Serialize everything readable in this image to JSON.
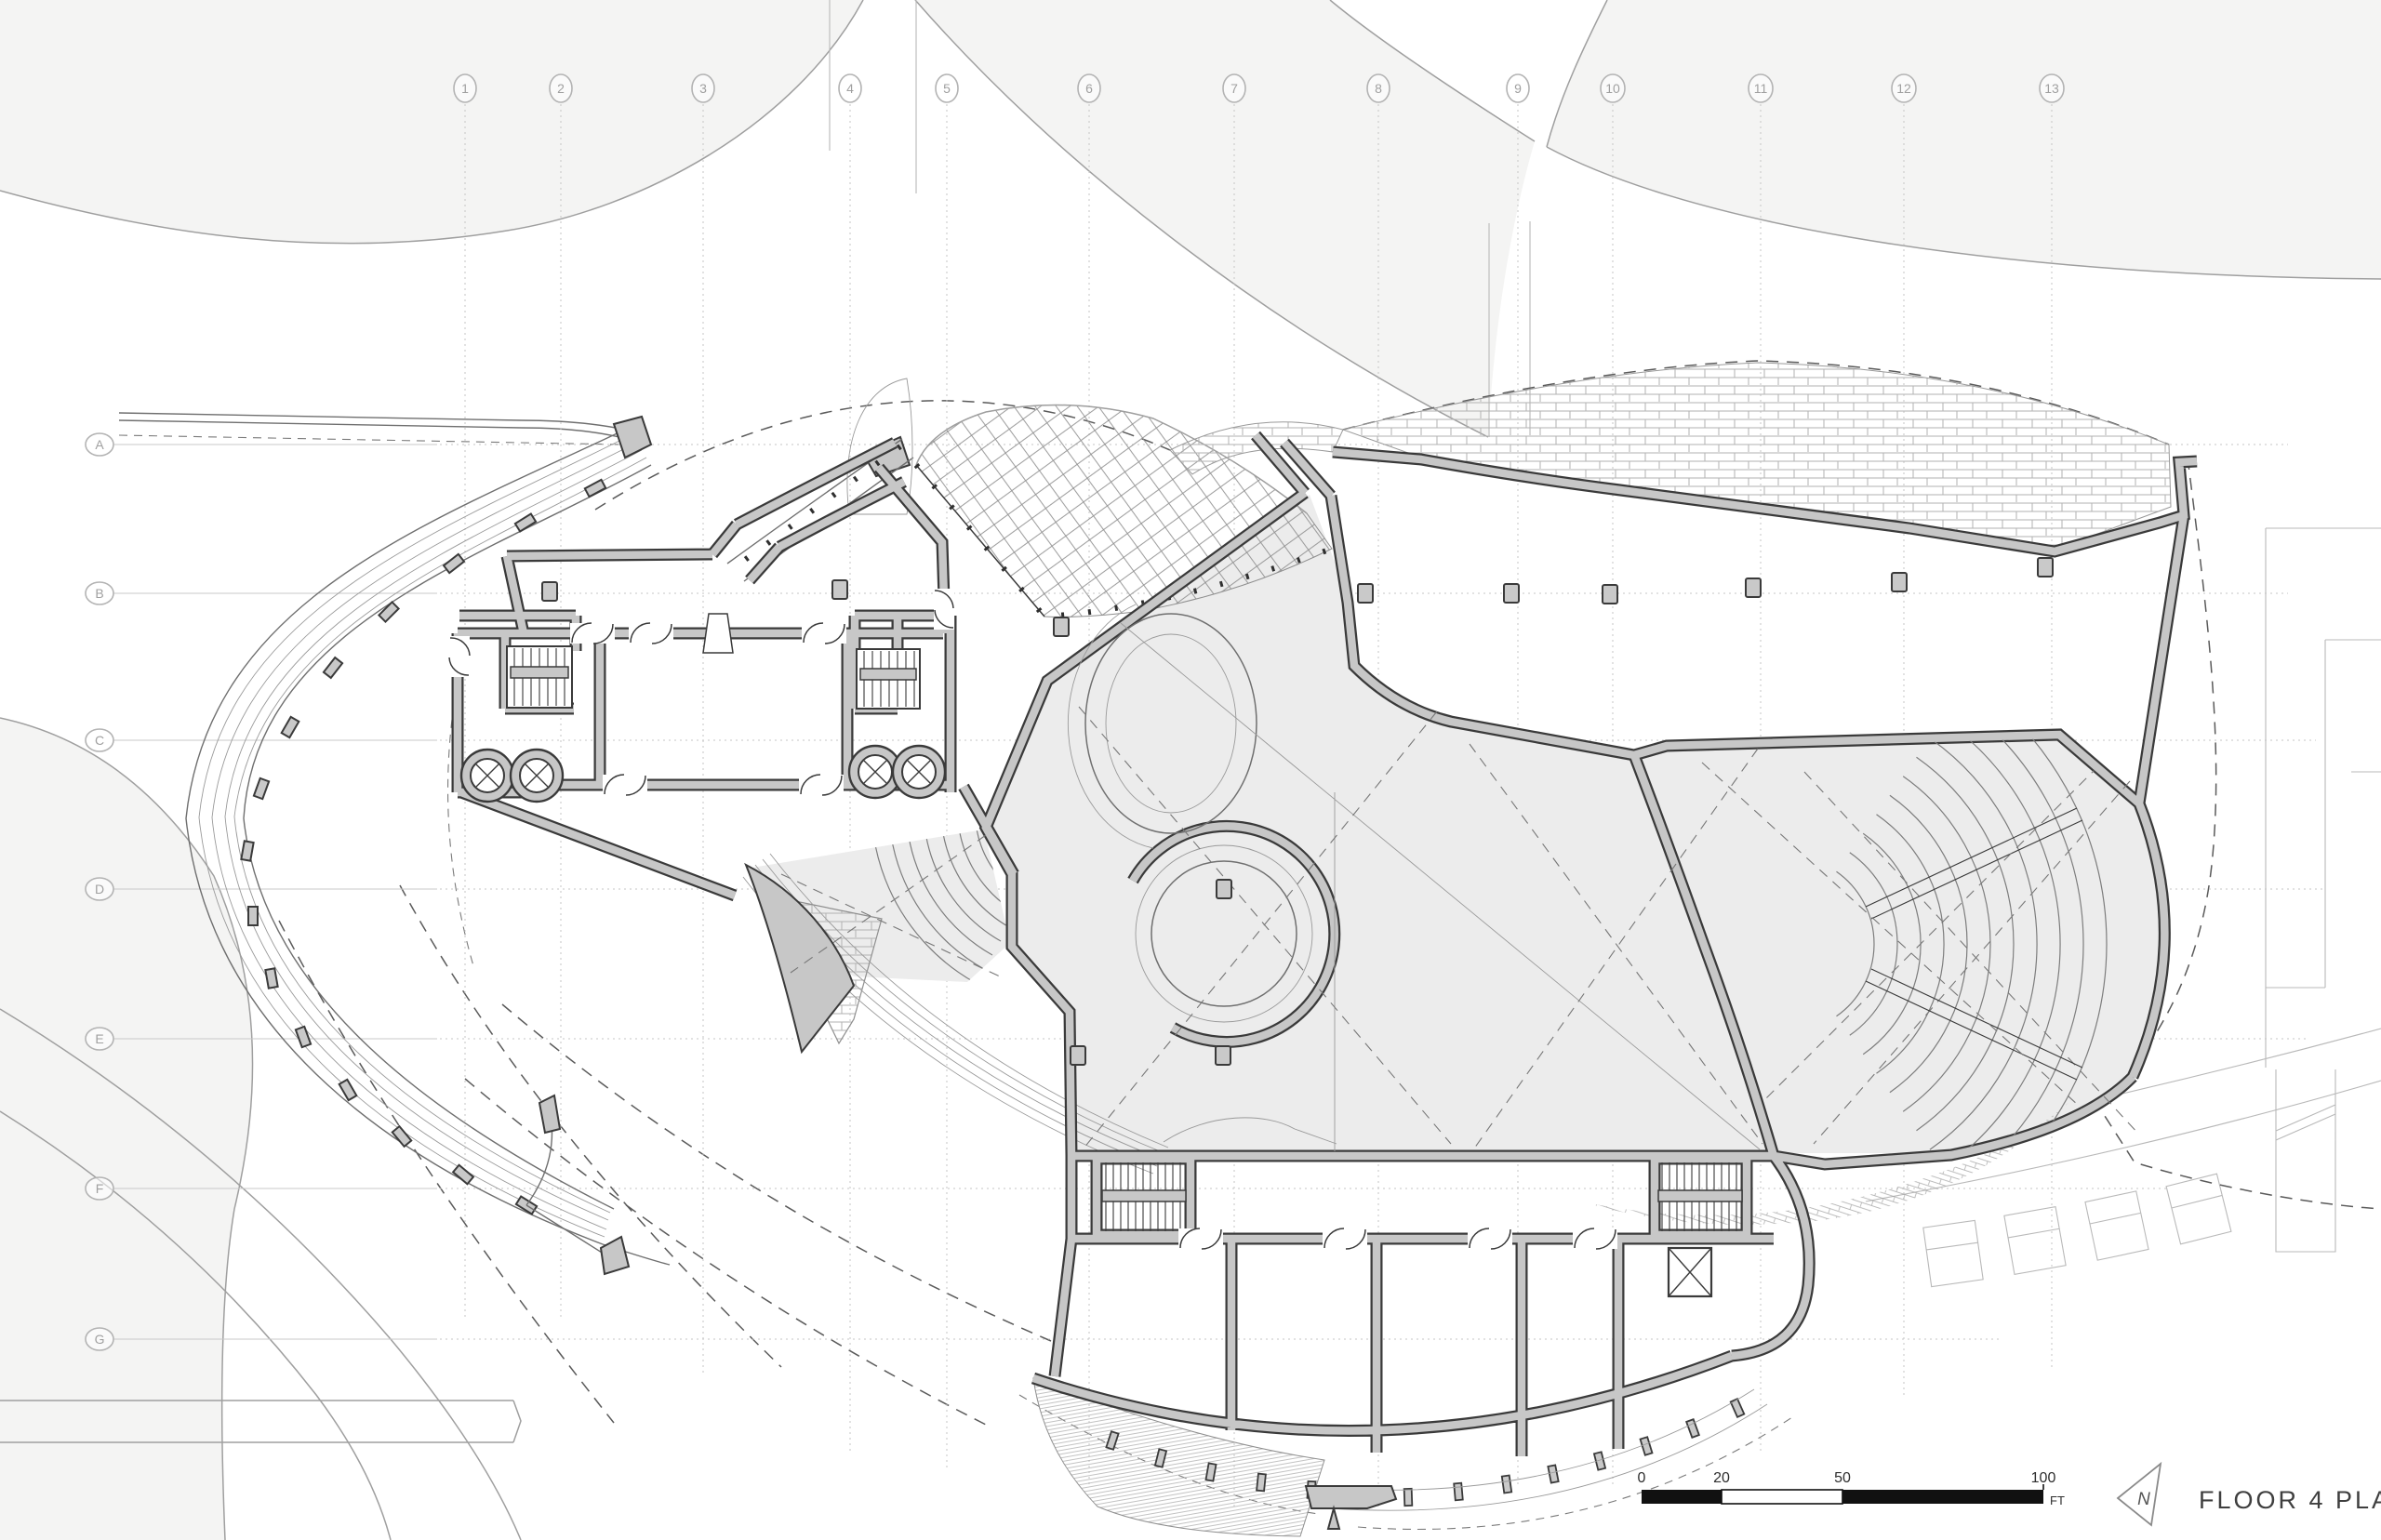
{
  "drawing": {
    "title": "FLOOR 4 PLAN",
    "north_label": "N"
  },
  "scale_bar": {
    "ticks": [
      "0",
      "20",
      "50",
      "100"
    ],
    "unit": "FT"
  },
  "grid": {
    "cols": [
      {
        "label": "1"
      },
      {
        "label": "2"
      },
      {
        "label": "3"
      },
      {
        "label": "4"
      },
      {
        "label": "5"
      },
      {
        "label": "6"
      },
      {
        "label": "7"
      },
      {
        "label": "8"
      },
      {
        "label": "9"
      },
      {
        "label": "10"
      },
      {
        "label": "11"
      },
      {
        "label": "12"
      },
      {
        "label": "13"
      }
    ],
    "rows": [
      {
        "label": "A"
      },
      {
        "label": "B"
      },
      {
        "label": "C"
      },
      {
        "label": "D"
      },
      {
        "label": "E"
      },
      {
        "label": "F"
      },
      {
        "label": "G"
      }
    ]
  },
  "colors": {
    "wall_fill": "#c7c7c7",
    "wall_line": "#3a3a3a",
    "floor_open": "#ececec",
    "context_line": "#9f9f9f",
    "grid_line": "#c6c6c6",
    "paper": "#ffffff"
  }
}
